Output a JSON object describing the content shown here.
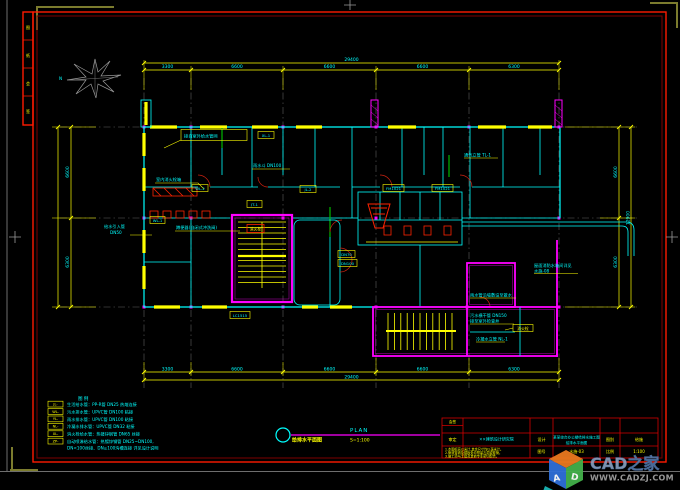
{
  "frame": {
    "strip_cells": [
      "图",
      "纸",
      "会",
      "签"
    ]
  },
  "north": {
    "label": "N"
  },
  "dims": {
    "top": {
      "segments": [
        "3300",
        "6600",
        "6600",
        "6600",
        "6300"
      ],
      "total": "29400"
    },
    "bottom": {
      "segments": [
        "3300",
        "6600",
        "6600",
        "6600",
        "6300"
      ],
      "total": "29400"
    },
    "left": {
      "segments": [
        "6600",
        "6300"
      ]
    },
    "right": {
      "segments": [
        "6600",
        "6300"
      ],
      "total": "12900"
    }
  },
  "plan": {
    "labels": [
      "接自室外给水管网",
      "雨水斗 DN100",
      "室内消火栓箱",
      "给水引入管",
      "DN50",
      "蹲便器(自闭式冲洗阀)",
      "屋面消防水箱间详见",
      "水施-08",
      "雨水管沿墙敷设至散水",
      "污水横干管 DN150",
      "接至室外检查井",
      "冷凝水立管 NL-1",
      "通气立管 TL-1"
    ],
    "tags": [
      "XL-1",
      "WL-2",
      "JL-2",
      "DN70",
      "DN100",
      "FM1021",
      "FM1021",
      "消火栓",
      "LC1515",
      "JT-1",
      "WL-1",
      "消火栓"
    ]
  },
  "legend": {
    "title": "图 例",
    "rows": [
      {
        "code": "JL-",
        "desc": "生活给水管：PP-R管 DN25 热熔连接"
      },
      {
        "code": "WL-",
        "desc": "污水排水管：UPVC管 DN100 粘接"
      },
      {
        "code": "YL-",
        "desc": "雨水排水管：UPVC管 DN100 粘接"
      },
      {
        "code": "NL-",
        "desc": "冷凝水排水管：UPVC管 DN32 粘接"
      },
      {
        "code": "XL-",
        "desc": "消火栓给水管：热镀锌钢管 DN65 丝接"
      },
      {
        "code": "ZP-",
        "desc": "自动喷淋给水管：热镀锌钢管 DN25~DN100,"
      }
    ],
    "cont": "DN<100丝接、DN≥100沟槽连接 详见设计说明"
  },
  "title": {
    "cn": "给排水平面图",
    "en": "PLAN",
    "scale": "S=1:100"
  },
  "title_block": {
    "huiqian": "会签",
    "shending": "审定",
    "company": "××建筑设计研究院",
    "sheji": "设计",
    "project": "某某综合办公楼给排水施工图",
    "drawing": "给排水平面图",
    "tubie": "图别",
    "tubie_v": "给施",
    "tuhao": "图号",
    "tuhao_v": "水施-03",
    "bili": "比例",
    "bili_v": "1:100",
    "notes": [
      "1.本图标高以米计,其余尺寸均以毫米计。",
      "2.管道穿墙及楼板处均预留孔洞或套管。",
      "3.施工须与土建及其他专业密切配合。"
    ]
  },
  "watermark": {
    "brand": "CAD之家",
    "url": "WWW.CADZJ.COM",
    "cube_a": "A",
    "cube_d": "D"
  }
}
